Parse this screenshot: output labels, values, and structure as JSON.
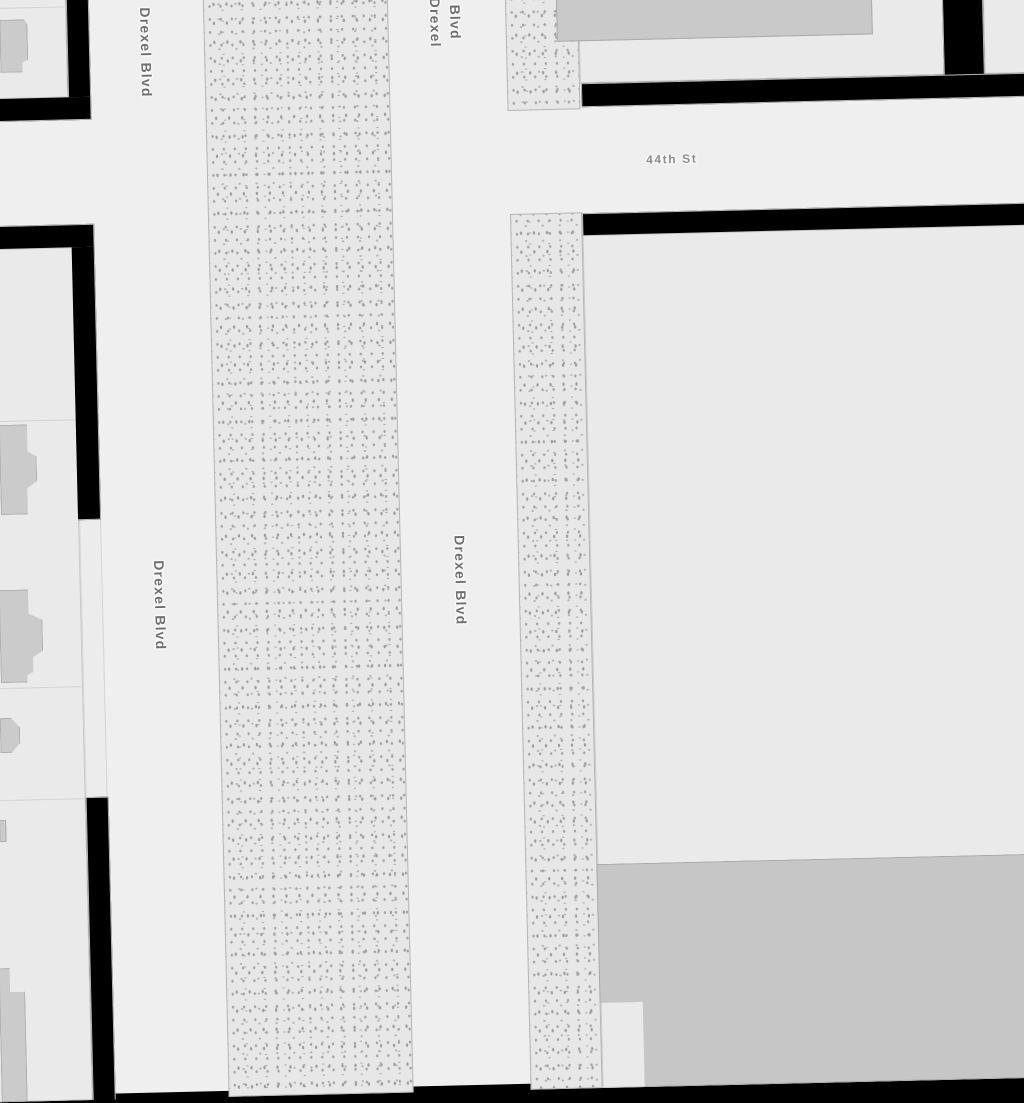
{
  "map": {
    "style": "grayscale street map",
    "labels": {
      "drexel_nw": "Drexel Blvd",
      "drexel_west": "Drexel Blvd",
      "drexel_center": "Drexel Blvd",
      "drexel_top_line1": "Drexel",
      "drexel_top_line2": "Blvd",
      "cross_street": "44th St"
    },
    "colors": {
      "road": "#efefef",
      "block": "#eaeaea",
      "background_gap": "#000000",
      "median_fill": "#e7e7e7",
      "median_dots": "#a8a8a8",
      "building": "#cbcbcb",
      "building_large": "#c6c6c6",
      "building_border": "#a9a9a9",
      "street_label": "#6e6e6e",
      "cross_street_label": "#8c8c8c"
    }
  }
}
